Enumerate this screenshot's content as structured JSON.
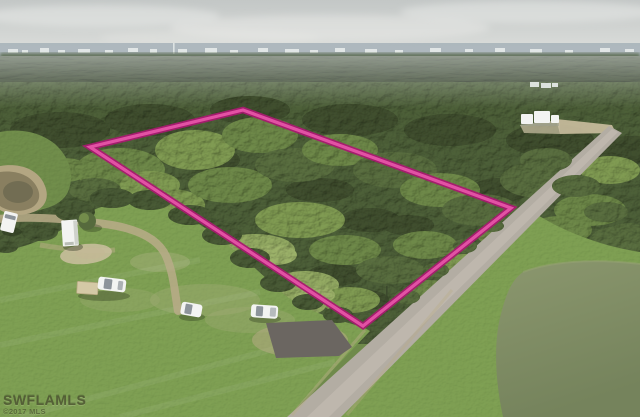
{
  "meta": {
    "type": "aerial-drone-photo",
    "description": "MLS real-estate aerial photograph of a wooded vacant-land parcel outlined in magenta, bordered by a paved road on the southeast, a cleared grass lot with gravel drive and parked white vehicles on the southwest, ponds at lower-left and lower-right, dense pine forest and a distant city skyline on the horizon under an overcast sky."
  },
  "watermark": {
    "line1": "SWFLAMLS",
    "line2": "©2017 MLS"
  },
  "parcel": {
    "label": "listed-parcel-boundary",
    "points": "90,147 243,110 511,208 363,326",
    "outline_color_name": "magenta"
  },
  "regions": {
    "sky": "overcast gray sky",
    "distant_city": "hazy city skyline on horizon",
    "pine_band": "dense dark pine tree line",
    "forest": "wooded acreage (subject parcel and surroundings)",
    "lawn": "mowed cleared lot with gravel drive",
    "road": "paved road running diagonally to lower center",
    "pond_left": "small muddy pond at left edge",
    "pond_right": "large murky retention pond at lower right",
    "vehicles": "five white vehicles and a utility trailer parked on cleared lot",
    "buildings": "white structures in clearing beyond road",
    "driveway_pad": "dark asphalt apron joining the road"
  },
  "colors": {
    "sky_top": "#c3c7c6",
    "sky_bottom": "#dfe1de",
    "cloud": "#eaece9",
    "horizon_band": "#a9b4ba",
    "horizon_treeline": "#5d6e55",
    "building_distant": "#e9edec",
    "pine": "#35422a",
    "forest_base": "#4a5c36",
    "forest_dark": "#3e4c2d",
    "forest_mid": "#566a3d",
    "forest_light": "#6a8446",
    "canopy_light": "#7b954f",
    "canopy_pale": "#8ea45f",
    "clearing": "#97ac66",
    "edge_tree": "#465733",
    "hill_grass": "#6f8c4a",
    "lawn": "#7d9e52",
    "lawn_worn": "#a2ad78",
    "dirt": "#b9ac88",
    "dirt_light": "#cbbfa0",
    "road": "#b3ada3",
    "road_light": "#c6c0b6",
    "pad": "#6b6661",
    "pond_left_rim": "#b3a682",
    "pond_left": "#897f60",
    "pond_left_dark": "#6d6950",
    "pond_right": "#8b976e",
    "pond_right_edge": "#75835c",
    "outline_outer": "#a81a70",
    "outline_inner": "#e251a4",
    "vehicle_white": "#f3f4f2",
    "vehicle_glass": "#8d949a",
    "trailer_tan": "#d4c9a6",
    "pole": "#3a452c",
    "watermark": "#4e5832"
  }
}
